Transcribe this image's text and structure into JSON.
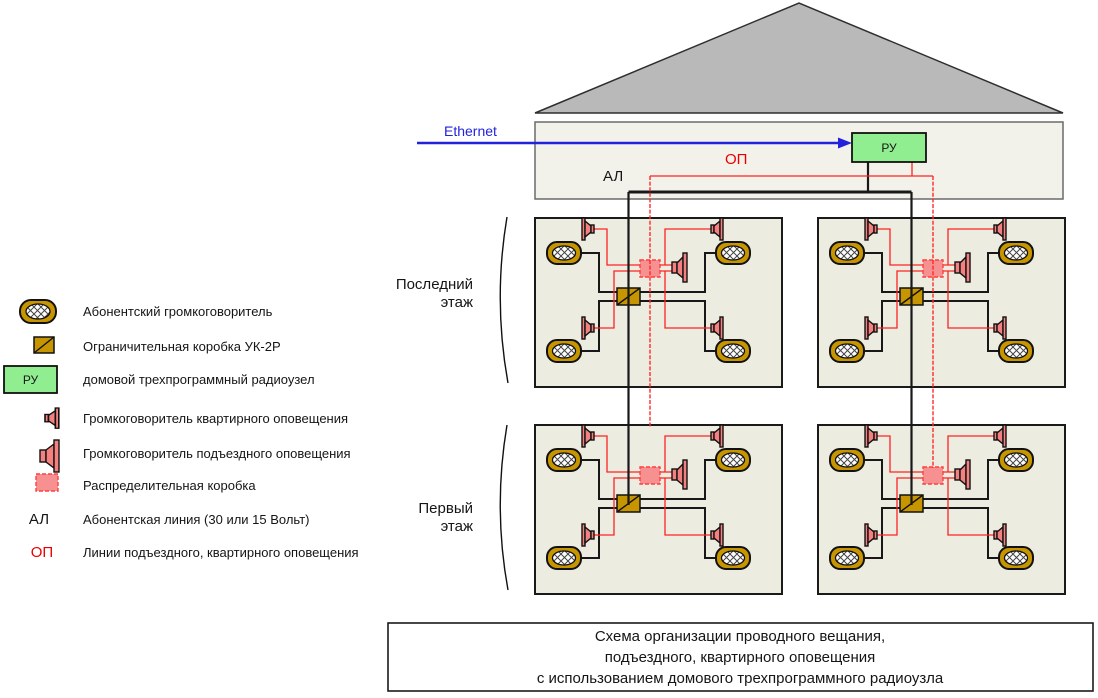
{
  "attic": {
    "ethernet_label": "Ethernet",
    "al_label": "АЛ",
    "op_label": "ОП",
    "ru_label": "РУ"
  },
  "floors": {
    "top_label_line1": "Последний",
    "top_label_line2": "этаж",
    "bottom_label_line1": "Первый",
    "bottom_label_line2": "этаж"
  },
  "legend": {
    "items": [
      {
        "icon": "subscriber-speaker-icon",
        "label": "Абонентский громкоговоритель"
      },
      {
        "icon": "limiter-box-icon",
        "label": "Ограничительная коробка УК-2Р"
      },
      {
        "icon": "radio-node-icon",
        "icon_text": "РУ",
        "label": "домовой трехпрограммный радиоузел"
      },
      {
        "icon": "apartment-speaker-icon",
        "label": "Громкоговоритель квартирного оповещения"
      },
      {
        "icon": "entrance-speaker-icon",
        "label": "Громкоговоритель подъездного оповещения"
      },
      {
        "icon": "distribution-box-icon",
        "label": "Распределительная коробка"
      },
      {
        "symbol": "АЛ",
        "label": "Абонентская линия (30 или 15 Вольт)"
      },
      {
        "symbol": "ОП",
        "label": "Линии подъездного, квартирного оповещения"
      }
    ]
  },
  "caption": {
    "lines": [
      "Схема организации проводного вещания,",
      "подъездного, квартирного оповещения",
      "с использованием домового трехпрограммного радиоузла"
    ]
  },
  "colors": {
    "gold": "#C79500",
    "salmon": "#F48080",
    "ru_green": "#90EE90",
    "red_line": "#FF2A2A",
    "blue": "#2222DD",
    "block_fill": "#ECECE0",
    "attic_fill": "#F2F2EA",
    "roof_fill": "#B9B9B9"
  }
}
